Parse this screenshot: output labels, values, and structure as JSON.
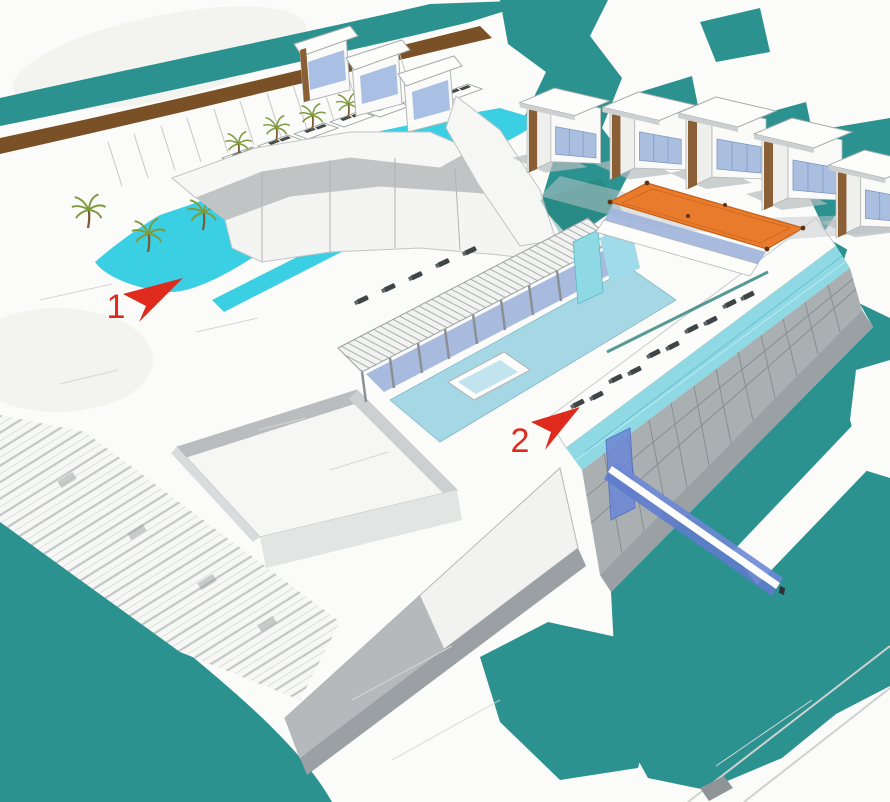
{
  "meta": {
    "type": "architectural-aerial-rendering",
    "subject": "waterfront resort hotel masterplan concept sketch",
    "view": "aerial perspective, hand-sketch over 3D massing"
  },
  "annotations": {
    "markers": [
      {
        "label": "1",
        "color": "#df2b1e",
        "points_at": "lagoon-pool-promenade",
        "arrow_direction": "up-right"
      },
      {
        "label": "2",
        "color": "#df2b1e",
        "points_at": "rooftop-infinity-pool-deck",
        "arrow_direction": "up-right"
      }
    ]
  },
  "palette": {
    "paper": "#fbfbf9",
    "water_teal": "#2b9290",
    "water_teal_dark": "#1f7a74",
    "pool_cyan": "#3bcfe4",
    "central_pool_blue": "#a6d7e4",
    "rooftop_pool_cyan": "#8ed9e4",
    "canopy_orange": "#e97b2d",
    "glass_blue": "#9fb4dc",
    "bridge_blue": "#6b87d6",
    "boardwalk_brown": "#7a5026",
    "facade_gray": "#aab0b2",
    "shadow_gray": "#c3c8cb",
    "palm_green": "#7f9a3e",
    "marker_red": "#df2b1e"
  },
  "features": [
    {
      "name": "sea-water",
      "description": "teal sea / canal surrounding the site"
    },
    {
      "name": "beach-water-band",
      "description": "shoreline strip at top left"
    },
    {
      "name": "boardwalk",
      "description": "brown timber boardwalk along the beach"
    },
    {
      "name": "lagoon-pool",
      "description": "bright cyan lagoon pool with cabanas and palms"
    },
    {
      "name": "curved-guestroom-wing",
      "description": "curved white hotel wing"
    },
    {
      "name": "villa-row",
      "description": "detached villas with blue glazing and timber slats"
    },
    {
      "name": "orange-shade-canopy",
      "description": "orange fabric canopy over colonnade"
    },
    {
      "name": "central-courtyard-pool",
      "description": "light blue courtyard pool with pergola"
    },
    {
      "name": "rooftop-infinity-pool",
      "description": "cyan infinity pool strip with sun loungers"
    },
    {
      "name": "seafront-building",
      "description": "long gridded facade block on the water"
    },
    {
      "name": "glass-footbridge",
      "description": "blue glass pedestrian bridge over canal"
    },
    {
      "name": "stepped-terraces",
      "description": "stepped terraces at lower left"
    }
  ]
}
